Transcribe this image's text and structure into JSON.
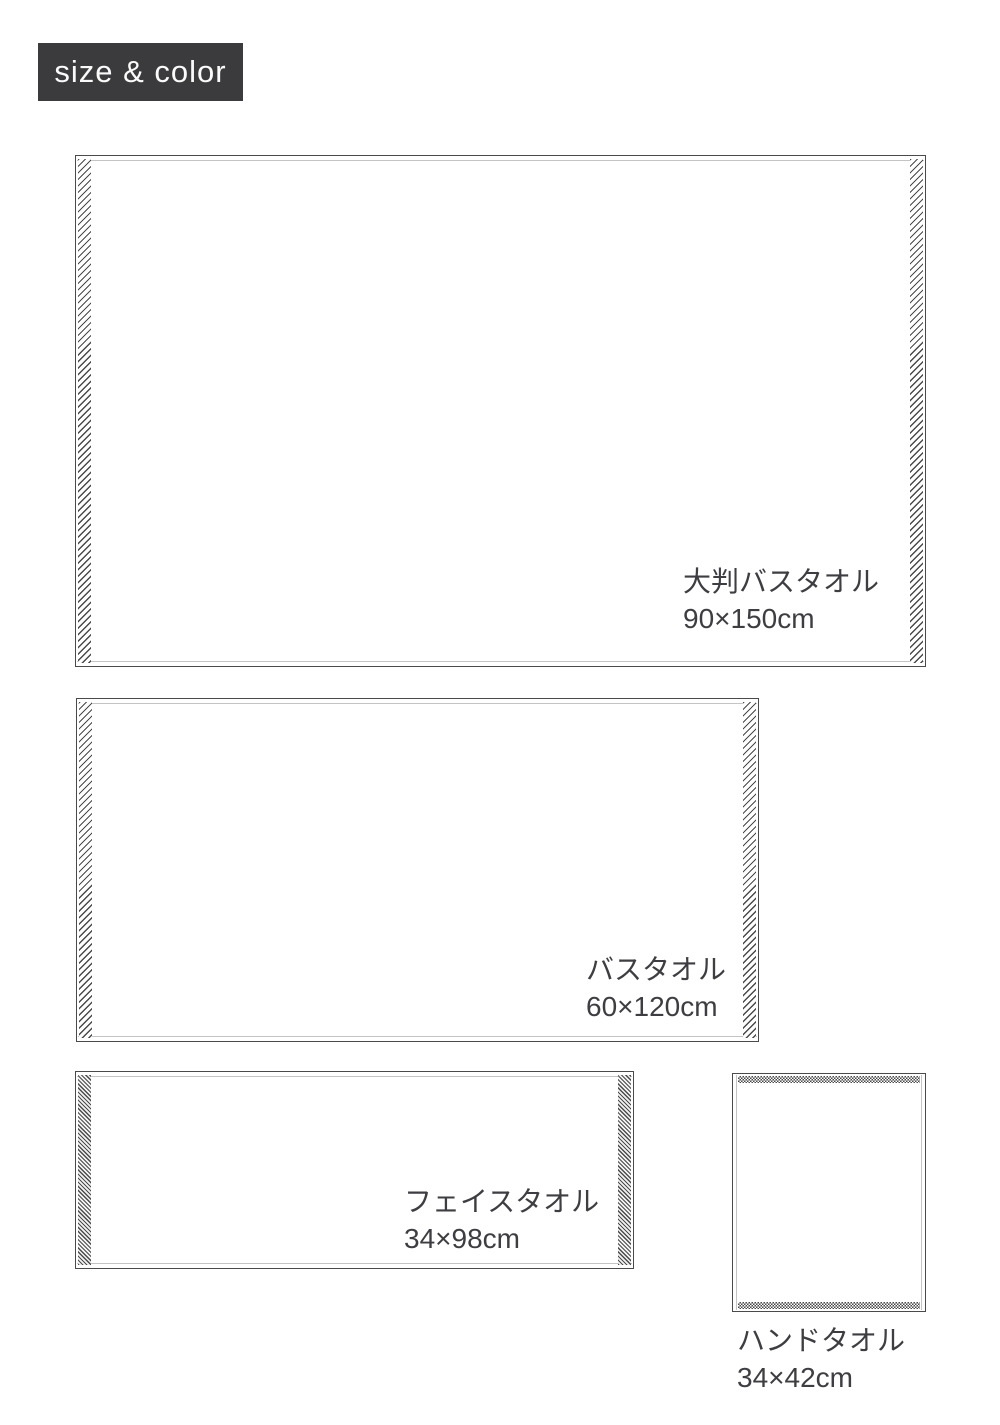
{
  "header": {
    "label": "size & color"
  },
  "towels": [
    {
      "name": "大判バスタオル",
      "size": "90×150cm"
    },
    {
      "name": "バスタオル",
      "size": "60×120cm"
    },
    {
      "name": "フェイスタオル",
      "size": "34×98cm"
    },
    {
      "name": "ハンドタオル",
      "size": "34×42cm"
    }
  ],
  "colors": {
    "badge_background": "#3b3b3d",
    "badge_text": "#fafafa",
    "towel_outline": "#4a4a4a",
    "hem_stitch_line": "#c4c4c4",
    "hatch": "#4a4a4a",
    "label_text": "#3d3d42",
    "page_background": "#ffffff"
  }
}
